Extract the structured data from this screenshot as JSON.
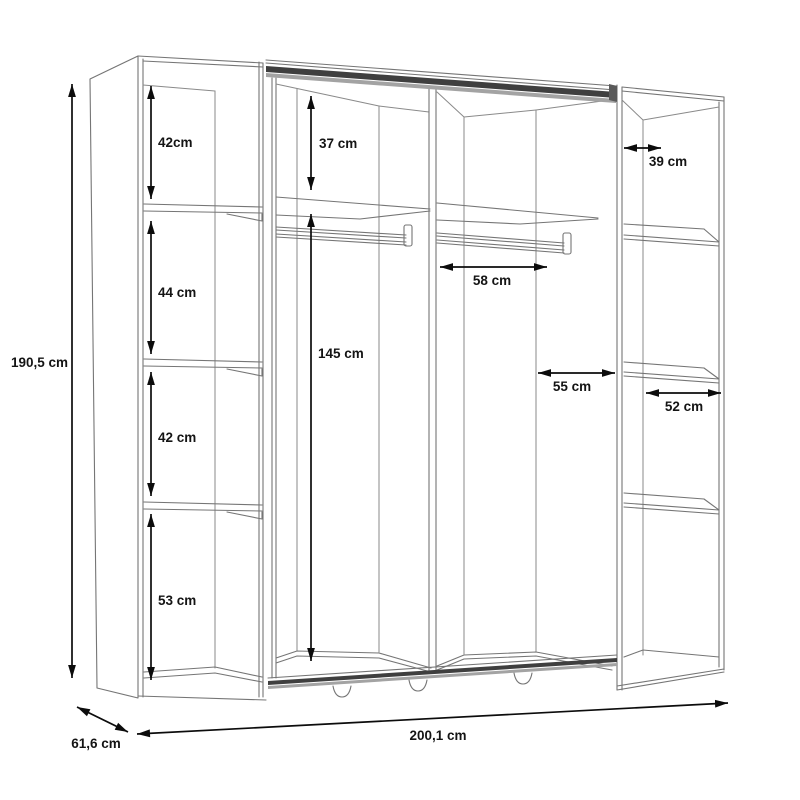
{
  "diagram": {
    "dimensions": {
      "overall_height": "190,5 cm",
      "overall_width": "200,1 cm",
      "overall_depth": "61,6 cm",
      "left_column_top_compartment": "42cm",
      "left_column_second_compartment": "44 cm",
      "left_column_third_compartment": "42 cm",
      "left_column_bottom_compartment": "53 cm",
      "middle_top_compartment_height": "37 cm",
      "middle_hanging_height": "145 cm",
      "middle_rail_span": "58 cm",
      "middle_right_span": "55 cm",
      "right_column_depth": "39 cm",
      "right_column_shelf_width": "52 cm"
    },
    "colors": {
      "background": "#ffffff",
      "cabinet_line": "#757575",
      "dimension_line": "#0c0c0c",
      "label_text": "#141414",
      "track_dark": "#3f3f3f",
      "track_light": "#a3a3a3"
    }
  }
}
